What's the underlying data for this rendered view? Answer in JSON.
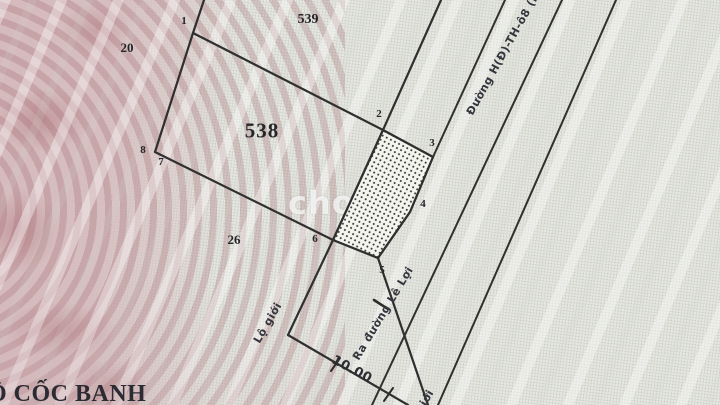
{
  "map": {
    "parcels": {
      "main": "538",
      "upper": "539",
      "left": "20",
      "lower": "26"
    },
    "vertex_labels": [
      "1",
      "2",
      "3",
      "4",
      "5",
      "6",
      "7",
      "8"
    ],
    "labels": {
      "road": "Đường H(Đ)-TH-ô8 (bê",
      "setback": "Lộ giới",
      "setback_partial": "giới",
      "access": "Ra đường Lê Lợi",
      "dimension": "10.00",
      "place_name": "Ồ CỐC BANH"
    },
    "watermark": "chợ",
    "colors": {
      "paper": "#e6e7e1",
      "pink_band": "#d5b8bb",
      "line": "#2f2f2f",
      "hatch_fill": "#f4f4ee"
    }
  }
}
